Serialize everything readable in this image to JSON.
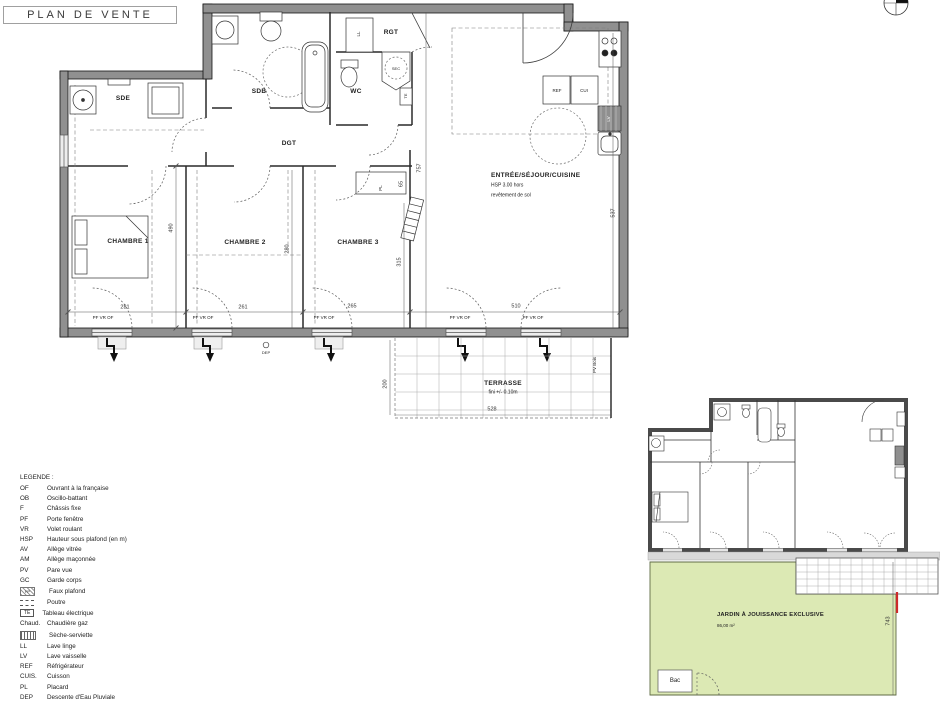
{
  "title": "PLAN DE VENTE",
  "main_plan": {
    "rooms": {
      "sde": "SDE",
      "sdb": "SDB",
      "wc": "WC",
      "rgt": "RGT",
      "dgt": "DGT",
      "ch1": "CHAMBRE 1",
      "ch2": "CHAMBRE 2",
      "ch3": "CHAMBRE 3",
      "sejour": "ENTRÉE/SÉJOUR/CUISINE",
      "sejour_note1": "HSP 3.00 hors",
      "sejour_note2": "revêtement de sol"
    },
    "fixtures": {
      "ll": "LL",
      "lv": "LV",
      "sec": "SEC",
      "te": "TE",
      "ref": "REF",
      "cui": "CUI",
      "pl": "PL"
    },
    "dims": {
      "d281": "281",
      "d261": "261",
      "d265": "265",
      "d510": "510",
      "d490": "490",
      "d280": "280",
      "d315": "315",
      "d757": "757",
      "d65": "65",
      "d537": "537"
    },
    "window_label": "PF VR OF",
    "dep": "DEP"
  },
  "terrasse": {
    "label": "TERRASSE",
    "note": "fini +/- 0.10m",
    "d528": "528",
    "d200": "200",
    "pv": "PV Bois"
  },
  "legend": {
    "title": "LEGENDE :",
    "items": [
      {
        "abbr": "OF",
        "desc": "Ouvrant à la française"
      },
      {
        "abbr": "OB",
        "desc": "Oscillo-battant"
      },
      {
        "abbr": "F",
        "desc": "Châssis fixe"
      },
      {
        "abbr": "PF",
        "desc": "Porte fenêtre"
      },
      {
        "abbr": "VR",
        "desc": "Volet roulant"
      },
      {
        "abbr": "HSP",
        "desc": "Hauteur sous plafond (en m)"
      },
      {
        "abbr": "AV",
        "desc": "Allège vitrée"
      },
      {
        "abbr": "AM",
        "desc": "Allège maçonnée"
      },
      {
        "abbr": "PV",
        "desc": "Pare vue"
      },
      {
        "abbr": "GC",
        "desc": "Garde corps"
      },
      {
        "abbr": "FP",
        "desc": "Faux plafond"
      },
      {
        "abbr": "",
        "desc": "Poutre"
      },
      {
        "abbr": "TE",
        "desc": "Tableau électrique"
      },
      {
        "abbr": "Chaud.",
        "desc": "Chaudière gaz"
      },
      {
        "abbr": "",
        "desc": "Sèche-serviette"
      },
      {
        "abbr": "LL",
        "desc": "Lave linge"
      },
      {
        "abbr": "LV",
        "desc": "Lave vaisselle"
      },
      {
        "abbr": "REF",
        "desc": "Réfrigérateur"
      },
      {
        "abbr": "CUIS.",
        "desc": "Cuisson"
      },
      {
        "abbr": "PL",
        "desc": "Placard"
      },
      {
        "abbr": "DEP",
        "desc": "Descente d'Eau Pluviale"
      },
      {
        "abbr": "",
        "desc": "Emmarchement"
      },
      {
        "abbr": "Bac",
        "desc": "Bac à compost"
      }
    ]
  },
  "annex": {
    "jardin": "JARDIN À JOUISSANCE EXCLUSIVE",
    "area": "86,00 m²",
    "d743": "743",
    "bac": "Bac"
  },
  "colors": {
    "wall": "#909090",
    "jardin_green": "#dce9b4",
    "red_mark": "#cc2a2a"
  }
}
